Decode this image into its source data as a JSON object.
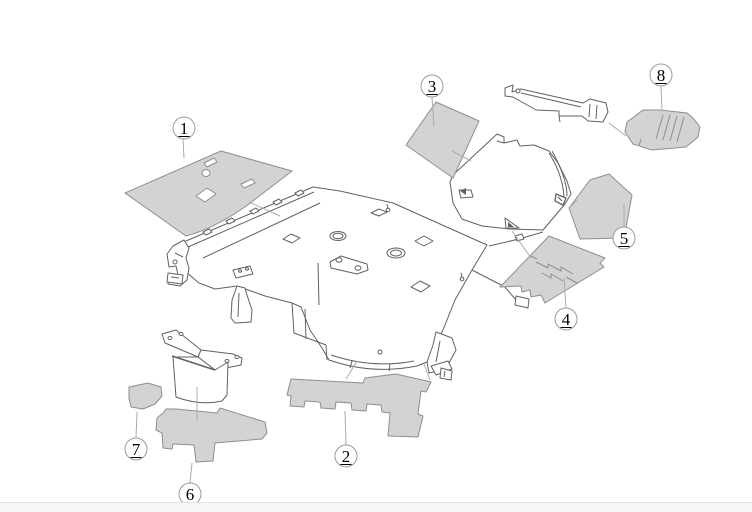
{
  "diagram": {
    "title": "Vehicle body insulation parts exploded diagram",
    "canvas": {
      "width": 752,
      "height": 512
    },
    "callout_radius": 11,
    "colors": {
      "white": "#ffffff",
      "part_fill": "#d3d3d3",
      "part_stroke": "#8e8e8e",
      "line": "#616161",
      "leader": "#ababab",
      "callout_stroke": "#9b9b9b",
      "callout_fill": "#ffffff",
      "text": "#000000",
      "footer_bg": "#f7f8fa",
      "footer_border": "#dde1ec"
    },
    "callouts": [
      {
        "label": "1",
        "x": 184,
        "y": 128
      },
      {
        "label": "2",
        "x": 346,
        "y": 456
      },
      {
        "label": "3",
        "x": 432,
        "y": 86
      },
      {
        "label": "4",
        "x": 566,
        "y": 319
      },
      {
        "label": "5",
        "x": 624,
        "y": 238
      },
      {
        "label": "6",
        "x": 190,
        "y": 494
      },
      {
        "label": "7",
        "x": 136,
        "y": 449
      },
      {
        "label": "8",
        "x": 661,
        "y": 75
      }
    ],
    "shapes": [
      {
        "n": "body-floor-outline",
        "d": "M186,241 L313,187 L340,191 L393,203 L487,245 L472,270 L455,300 L443,330 L427,362 L417,366 Q372,375 329,360 L322,348 L310,330 L301,307 L292,303 L265,296 L237,286 L215,289 L199,283 L186,272 L176,266 L169,258 L174,249 Z",
        "f": "white",
        "s": "line"
      },
      {
        "n": "cowl-inner-line",
        "d": "M188,247 L314,192",
        "f": "none",
        "s": "line"
      },
      {
        "n": "cowl-inner-line",
        "d": "M203,258 L320,203",
        "f": "none",
        "s": "line"
      },
      {
        "n": "cowl-clip",
        "d": "M203,232 l6,-3 l3,3 l-6,3 Z",
        "f": "white",
        "s": "line"
      },
      {
        "n": "cowl-clip",
        "d": "M226,221 l6,-3 l3,3 l-6,3 Z",
        "f": "white",
        "s": "line"
      },
      {
        "n": "cowl-clip",
        "d": "M250,211 l6,-3 l3,3 l-6,3 Z",
        "f": "white",
        "s": "line"
      },
      {
        "n": "cowl-clip",
        "d": "M273,202 l6,-3 l3,3 l-6,3 Z",
        "f": "white",
        "s": "line"
      },
      {
        "n": "cowl-clip",
        "d": "M295,193 l6,-3 l3,3 l-6,3 Z",
        "f": "white",
        "s": "line"
      },
      {
        "n": "left-bracket",
        "d": "M184,240 L173,246 L167,254 L169,267 L176,266 L178,275 L169,278 L168,284 L180,286 L187,280 L189,268 L186,258 L189,248 Z",
        "f": "white",
        "s": "line"
      },
      {
        "n": "left-bracket-detail",
        "d": "M175,253 L183,257",
        "f": "none",
        "s": "line"
      },
      {
        "n": "left-bracket-hole",
        "e": [
          175,
          262,
          2,
          2
        ],
        "f": "white",
        "s": "line"
      },
      {
        "n": "floor-hole",
        "e": [
          338,
          236,
          8,
          4.5
        ],
        "f": "white",
        "s": "line"
      },
      {
        "n": "floor-hole",
        "e": [
          338,
          236,
          5,
          2.7
        ],
        "f": "white",
        "s": "line"
      },
      {
        "n": "floor-hole",
        "e": [
          396,
          253,
          9,
          5
        ],
        "f": "white",
        "s": "line"
      },
      {
        "n": "floor-hole",
        "e": [
          396,
          253,
          5.5,
          3
        ],
        "f": "white",
        "s": "line"
      },
      {
        "n": "floor-cutout",
        "d": "M283,239 L291,234 L300,238 L292,243 Z",
        "f": "white",
        "s": "line"
      },
      {
        "n": "floor-cutout",
        "d": "M415,241 L424,236 L433,241 L424,246 Z",
        "f": "white",
        "s": "line"
      },
      {
        "n": "floor-cutout",
        "d": "M411,287 L420,281 L430,286 L421,292 Z",
        "f": "white",
        "s": "line"
      },
      {
        "n": "floor-cutout",
        "d": "M371,213 L379,209 L387,212 L379,216 Z",
        "f": "white",
        "s": "line"
      },
      {
        "n": "seat-bracket",
        "d": "M330,262 L341,256 L367,264 L368,270 L357,274 L331,268 Z",
        "f": "white",
        "s": "line"
      },
      {
        "n": "seat-bolt",
        "e": [
          339,
          260,
          3,
          2.2
        ],
        "f": "white",
        "s": "line"
      },
      {
        "n": "seat-bolt",
        "e": [
          358,
          268,
          3,
          2.2
        ],
        "f": "white",
        "s": "line"
      },
      {
        "n": "seat-strut",
        "d": "M318,263 L319,305",
        "f": "none",
        "s": "line"
      },
      {
        "n": "tunnel-edge",
        "d": "M292,303 L294,333 L326,345 L327,360",
        "f": "none",
        "s": "line"
      },
      {
        "n": "tunnel-edge",
        "d": "M305,309 L306,339",
        "f": "none",
        "s": "line"
      },
      {
        "n": "clip-symbol",
        "e": [
          388,
          210,
          1.8,
          1.8
        ],
        "f": "white",
        "s": "line"
      },
      {
        "n": "clip-symbol",
        "d": "M388,208 L387,204",
        "f": "none",
        "s": "line"
      },
      {
        "n": "clip-symbol",
        "e": [
          462,
          279,
          1.8,
          1.8
        ],
        "f": "white",
        "s": "line"
      },
      {
        "n": "clip-symbol",
        "d": "M462,277 L461,273",
        "f": "none",
        "s": "line"
      },
      {
        "n": "left-pillar-leg",
        "d": "M237,286 L232,300 L231,318 L235,323 L251,322 L252,310 L247,295 L245,288 Z",
        "f": "white",
        "s": "line"
      },
      {
        "n": "left-pillar-leg-line",
        "d": "M239,293 L238,317",
        "f": "none",
        "s": "line"
      },
      {
        "n": "left-pillar-bracket",
        "d": "M233,270 L250,266 L253,274 L236,278 Z",
        "f": "white",
        "s": "line"
      },
      {
        "n": "pillar-bolt",
        "e": [
          240,
          271,
          1.5,
          1.2
        ],
        "f": "white",
        "s": "line"
      },
      {
        "n": "pillar-bolt",
        "e": [
          247,
          269,
          1.5,
          1.2
        ],
        "f": "white",
        "s": "line"
      },
      {
        "n": "left-leg-foot",
        "d": "M168,273 L183,275 L182,284 L167,282 Z",
        "f": "white",
        "s": "line"
      },
      {
        "n": "left-leg-foot-line",
        "d": "M171,277 L179,278",
        "f": "none",
        "s": "line"
      },
      {
        "n": "right-leg",
        "d": "M436,332 L452,338 L456,350 L449,363 L438,371 L429,373 L427,362 L433,345 Z",
        "f": "white",
        "s": "line"
      },
      {
        "n": "right-leg-line",
        "d": "M440,341 L436,362",
        "f": "none",
        "s": "line"
      },
      {
        "n": "right-leg-foot",
        "d": "M431,366 L448,361 L452,369 L436,375 Z",
        "f": "white",
        "s": "line"
      },
      {
        "n": "rear-rail",
        "d": "M472,270 L505,287 L516,300",
        "f": "none",
        "s": "line"
      },
      {
        "n": "rear-rail-bracket",
        "d": "M516,296 L529,299 L528,308 L515,305 Z",
        "f": "white",
        "s": "line"
      },
      {
        "n": "rear-bracket",
        "d": "M441,368 L452,371 L451,380 L440,378 Z",
        "f": "white",
        "s": "line"
      },
      {
        "n": "rear-bracket-line",
        "d": "M445,371 L444,377",
        "f": "none",
        "s": "line"
      },
      {
        "n": "sill-inner-arc",
        "d": "M331,355 Q373,369 414,361",
        "f": "none",
        "s": "line"
      },
      {
        "n": "sill-clip",
        "d": "M352,361 L350,368",
        "f": "none",
        "s": "line"
      },
      {
        "n": "sill-clip",
        "d": "M390,364 L389,371",
        "f": "none",
        "s": "line"
      },
      {
        "n": "sill-clip",
        "e": [
          380,
          352,
          2,
          2
        ],
        "f": "white",
        "s": "line"
      },
      {
        "n": "deck-line",
        "d": "M489,246 L519,239 L543,232",
        "f": "none",
        "s": "line"
      },
      {
        "n": "deck-clip",
        "d": "M515,236 L522,234 L524,239 L517,241 Z",
        "f": "white",
        "s": "line"
      },
      {
        "n": "quarter-panel",
        "d": "M450,182 L453,175 L497,134 L504,137 L504,143 L517,140 L520,146 L534,145 L549,151 L558,163 L567,181 L571,194 L565,204 L543,230 L510,229 L482,226 L462,219 L453,203 Z",
        "f": "white",
        "s": "line"
      },
      {
        "n": "quarter-panel-roll",
        "d": "M549,153 Q564,177 564,200",
        "f": "none",
        "s": "line"
      },
      {
        "n": "quarter-panel-roll",
        "d": "M552,151 Q567,178 567,196",
        "f": "none",
        "s": "line"
      },
      {
        "n": "quarter-panel-flag",
        "d": "M459,190 L471,190 L473,197 L461,198 Z",
        "f": "white",
        "s": "line"
      },
      {
        "n": "quarter-panel-flag-fill",
        "d": "M460,191 L466,188 L466,195 Z",
        "f": "line",
        "s": "none"
      },
      {
        "n": "quarter-panel-tri",
        "d": "M505,218 L519,228 L506,228 Z",
        "f": "white",
        "s": "line"
      },
      {
        "n": "quarter-panel-tri-fill",
        "d": "M508,222 L514,227 L508,227 Z",
        "f": "line",
        "s": "none"
      },
      {
        "n": "quarter-corner-clip",
        "d": "M556,194 L566,198 L563,205 L555,201 Z",
        "f": "white",
        "s": "line",
        "w": 1.3
      },
      {
        "n": "quarter-corner-clip-line",
        "d": "M558,197 L562,201",
        "f": "none",
        "s": "line",
        "w": 1.2
      },
      {
        "n": "quarter-panel-tab-line",
        "d": "M497,141 L504,143",
        "f": "none",
        "s": "line"
      },
      {
        "n": "upper-bracket",
        "d": "M505,88 L513,85 L512,92 L521,89 L583,103 L590,99 L606,103 L608,112 L603,122 L588,121 L582,116 L559,116 L559,111 L536,110 L513,97 L505,96 Z",
        "f": "white",
        "s": "line"
      },
      {
        "n": "upper-bracket-hole",
        "e": [
          518,
          91,
          2,
          2
        ],
        "f": "white",
        "s": "line"
      },
      {
        "n": "upper-bracket-fold",
        "d": "M590,104 L589,117",
        "f": "none",
        "s": "line"
      },
      {
        "n": "upper-bracket-fold",
        "d": "M597,105 L596,119",
        "f": "none",
        "s": "line"
      },
      {
        "n": "upper-bracket-edge",
        "d": "M521,93 L581,107",
        "f": "none",
        "s": "line"
      },
      {
        "n": "upper-bracket-tab",
        "d": "M559,116 L560,122",
        "f": "none",
        "s": "line"
      },
      {
        "n": "lower-bracket-plate",
        "d": "M162,334 L176,330 L201,350 L198,357 L165,343 Z",
        "f": "white",
        "s": "line"
      },
      {
        "n": "lower-bracket-plate",
        "d": "M201,350 L233,354 L242,358 L241,365 L215,370 L198,357 Z",
        "f": "white",
        "s": "line"
      },
      {
        "n": "lower-bracket-hole",
        "e": [
          170,
          338,
          2,
          1.5
        ],
        "f": "white",
        "s": "line"
      },
      {
        "n": "lower-bracket-hole",
        "e": [
          181,
          334,
          2,
          1.5
        ],
        "f": "white",
        "s": "line"
      },
      {
        "n": "lower-bracket-hole",
        "e": [
          227,
          361,
          2,
          1.5
        ],
        "f": "white",
        "s": "line"
      },
      {
        "n": "lower-bracket-hole",
        "e": [
          237,
          357,
          2,
          1.5
        ],
        "f": "white",
        "s": "line"
      },
      {
        "n": "lower-bracket-box",
        "d": "M173,357 L176,397 Q200,406 222,401 L227,395 L228,362 L215,370 L198,357 Z",
        "f": "white",
        "s": "line"
      },
      {
        "n": "lower-bracket-fold",
        "d": "M172,356 L215,370",
        "f": "none",
        "s": "line",
        "w": 1.5
      },
      {
        "n": "part-1-shape",
        "d": "M125,193 L221,151 L292,171 L249,204 Q216,228 186,236 Q155,214 125,193 Z",
        "f": "part_fill",
        "s": "part_stroke"
      },
      {
        "n": "part-1-cutout",
        "d": "M204,163 L214,158 L217,162 L207,167 Z",
        "f": "white",
        "s": "part_stroke"
      },
      {
        "n": "part-1-cutout",
        "e": [
          206,
          173,
          4,
          3.5
        ],
        "f": "white",
        "s": "part_stroke"
      },
      {
        "n": "part-1-cutout",
        "d": "M241,184 L252,179 L255,183 L244,188 Z",
        "f": "white",
        "s": "part_stroke"
      },
      {
        "n": "part-1-cutout",
        "d": "M196,196 L207,188 L216,194 L205,202 Z",
        "f": "white",
        "s": "part_stroke"
      },
      {
        "n": "part-3-shape",
        "d": "M406,145 L436,102 L479,121 L453,178 Z",
        "f": "part_fill",
        "s": "part_stroke"
      },
      {
        "n": "part-5-shape",
        "d": "M590,180 L609,174 L632,195 L624,238 L580,239 L569,208 Z",
        "f": "part_fill",
        "s": "part_stroke"
      },
      {
        "n": "part-8-shape",
        "d": "M627,122 L643,110 L660,110 L687,113 L694,119 L700,127 L698,137 L686,147 L652,150 L633,144 L625,132 Z",
        "f": "part_fill",
        "s": "part_stroke"
      },
      {
        "n": "part-8-hatch",
        "d": "M663,115 L656,139",
        "f": "none",
        "s": "part_stroke"
      },
      {
        "n": "part-8-hatch",
        "d": "M670,115 L663,140",
        "f": "none",
        "s": "part_stroke"
      },
      {
        "n": "part-8-hatch",
        "d": "M677,116 L670,141",
        "f": "none",
        "s": "part_stroke"
      },
      {
        "n": "part-8-hatch",
        "d": "M684,117 L677,142",
        "f": "none",
        "s": "part_stroke"
      },
      {
        "n": "part-8-notch",
        "d": "M639,146 L641,139",
        "f": "none",
        "s": "part_stroke"
      },
      {
        "n": "part-4-shape",
        "d": "M549,236 L605,258 L600,263 L604,267 L545,303 L541,295 L531,297 L530,290 L522,292 L521,286 L500,287 Z",
        "f": "part_fill",
        "s": "part_stroke"
      },
      {
        "n": "part-4-detail",
        "d": "M536,262 L548,268 L548,264 L561,271 L561,267 L573,274",
        "f": "none",
        "s": "part_stroke"
      },
      {
        "n": "part-4-detail",
        "d": "M542,273 L551,278 L551,274 L563,281",
        "f": "none",
        "s": "part_stroke"
      },
      {
        "n": "part-4-detail",
        "d": "M531,256 L537,259",
        "f": "none",
        "s": "part_stroke"
      },
      {
        "n": "part-4-detail",
        "d": "M566,277 L577,283",
        "f": "none",
        "s": "part_stroke"
      },
      {
        "n": "part-2-shape",
        "d": "M291,379 L363,383 L365,378 L396,374 L431,382 L426,392 L421,391 L418,414 L423,416 L418,437 L388,436 L390,413 L382,412 L381,405 L367,404 L366,411 L352,410 L351,403 L336,402 L335,409 L321,408 L320,402 L305,401 L304,407 L290,406 L291,396 L287,395 Z",
        "f": "part_fill",
        "s": "part_stroke"
      },
      {
        "n": "part-6-shape",
        "d": "M157,418 L164,412 L166,409 L176,409 L217,413 L220,408 L265,422 L267,433 L262,439 L215,443 L213,461 L196,462 L194,445 L173,444 L172,449 L163,448 L162,433 L156,430 Z",
        "f": "part_fill",
        "s": "part_stroke"
      },
      {
        "n": "part-7-shape",
        "d": "M129,387 L148,383 L161,387 L162,396 L155,404 L143,409 L131,407 L129,398 Z",
        "f": "part_fill",
        "s": "part_stroke"
      },
      {
        "n": "leader-line-1",
        "d": "M183,139 L184,158",
        "f": "none",
        "s": "leader"
      },
      {
        "n": "leader-line-1b",
        "d": "M249,202 L280,216",
        "f": "none",
        "s": "leader"
      },
      {
        "n": "leader-line-2",
        "d": "M345,411 L346,445",
        "f": "none",
        "s": "leader"
      },
      {
        "n": "leader-line-2b",
        "d": "M357,361 L346,379",
        "f": "none",
        "s": "leader"
      },
      {
        "n": "leader-line-2c",
        "d": "M424,364 L430,380",
        "f": "none",
        "s": "leader"
      },
      {
        "n": "leader-line-3",
        "d": "M432,97 L434,126",
        "f": "none",
        "s": "leader"
      },
      {
        "n": "leader-line-3b",
        "d": "M452,151 L471,161",
        "f": "none",
        "s": "leader"
      },
      {
        "n": "leader-line-4",
        "d": "M564,278 L566,308",
        "f": "none",
        "s": "leader"
      },
      {
        "n": "leader-line-4b",
        "d": "M512,231 L531,258",
        "f": "none",
        "s": "leader"
      },
      {
        "n": "leader-line-5",
        "d": "M624,204 L624,227",
        "f": "none",
        "s": "leader"
      },
      {
        "n": "leader-line-5b",
        "d": "M577,200 L570,207",
        "f": "none",
        "s": "leader"
      },
      {
        "n": "leader-line-6",
        "d": "M197,387 L197,421",
        "f": "none",
        "s": "leader"
      },
      {
        "n": "leader-line-6b",
        "d": "M190,483 L192,463",
        "f": "none",
        "s": "leader"
      },
      {
        "n": "leader-line-7",
        "d": "M137,412 L136,438",
        "f": "none",
        "s": "leader"
      },
      {
        "n": "leader-line-8",
        "d": "M661,86 L662,111",
        "f": "none",
        "s": "leader"
      },
      {
        "n": "leader-line-8b",
        "d": "M609,123 L626,136",
        "f": "none",
        "s": "leader"
      }
    ]
  },
  "footer": {
    "visible": true
  }
}
